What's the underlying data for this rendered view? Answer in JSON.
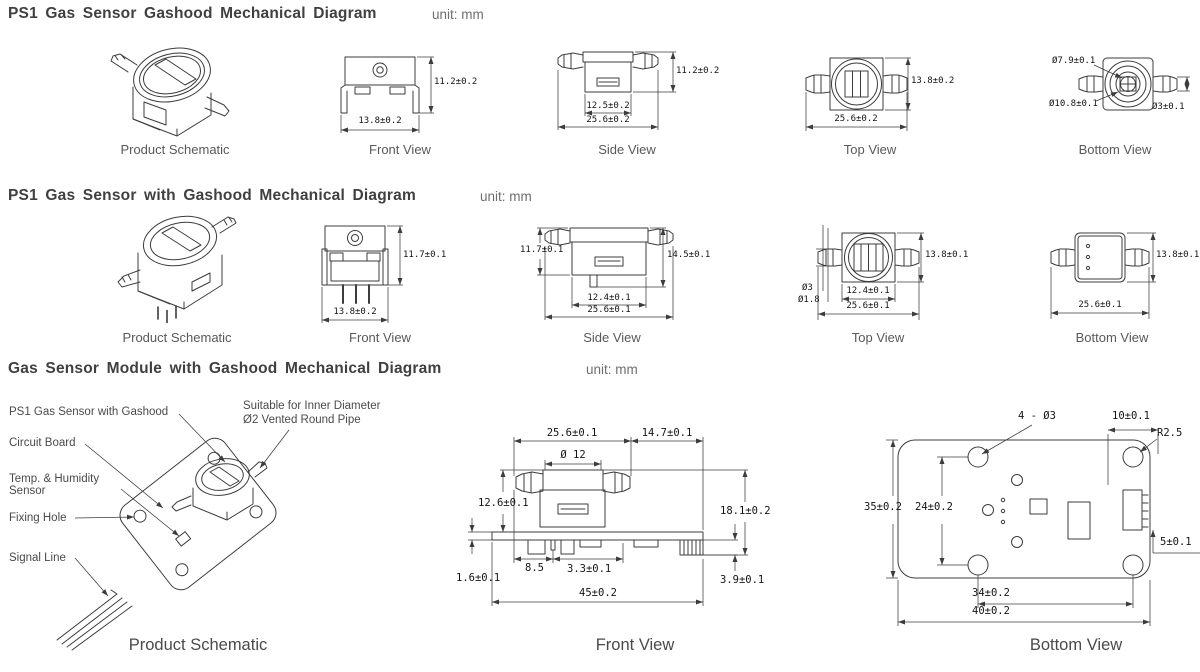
{
  "sections": [
    {
      "title": "PS1 Gas Sensor Gashood Mechanical Diagram",
      "unit": "unit: mm",
      "schematic": {
        "caption": "Product Schematic"
      },
      "front": {
        "caption": "Front View",
        "height": "11.2±0.2",
        "width": "13.8±0.2"
      },
      "side": {
        "caption": "Side View",
        "height": "11.2±0.2",
        "inner_width": "12.5±0.2",
        "width": "25.6±0.2"
      },
      "top": {
        "caption": "Top View",
        "height": "13.8±0.2",
        "width": "25.6±0.2"
      },
      "bottom": {
        "caption": "Bottom View",
        "inner_dia": "Ø7.9±0.1",
        "outer_dia": "Ø10.8±0.1",
        "nozzle_dia": "Ø3±0.1"
      }
    },
    {
      "title": "PS1 Gas Sensor with Gashood Mechanical Diagram",
      "unit": "unit: mm",
      "schematic": {
        "caption": "Product Schematic"
      },
      "front": {
        "caption": "Front View",
        "height": "11.7±0.1",
        "width": "13.8±0.2"
      },
      "side": {
        "caption": "Side View",
        "height": "11.7±0.1",
        "total_height": "14.5±0.1",
        "inner_width": "12.4±0.1",
        "width": "25.6±0.1"
      },
      "top": {
        "caption": "Top View",
        "height": "13.8±0.1",
        "inner_width": "12.4±0.1",
        "width": "25.6±0.1",
        "nozzle_od": "Ø3",
        "nozzle_id": "Ø1.8"
      },
      "bottom": {
        "caption": "Bottom View",
        "height": "13.8±0.1",
        "width": "25.6±0.1"
      }
    },
    {
      "title": "Gas Sensor Module with Gashood Mechanical Diagram",
      "unit": "unit: mm",
      "schematic": {
        "caption": "Product Schematic",
        "labels": {
          "sensor": "PS1 Gas Sensor with Gashood",
          "pipe_line1": "Suitable for Inner Diameter",
          "pipe_line2": "Ø2 Vented Round Pipe",
          "circuit_board": "Circuit Board",
          "temp_line1": "Temp. & Humidity",
          "temp_line2": "Sensor",
          "fixing_hole": "Fixing Hole",
          "signal_line": "Signal Line"
        }
      },
      "front": {
        "caption": "Front View",
        "sensor_width": "25.6±0.1",
        "right_span": "14.7±0.1",
        "hood_dia": "Ø 12",
        "sensor_height": "12.6±0.1",
        "total_height": "18.1±0.2",
        "pin_offset": "8.5",
        "pin_pitch": "3.3±0.1",
        "board_thickness": "1.6±0.1",
        "connector_drop": "3.9±0.1",
        "total_width": "45±0.2"
      },
      "bottom": {
        "caption": "Bottom View",
        "holes": "4 - Ø3",
        "right_span": "10±0.1",
        "corner_radius": "R2.5",
        "height": "35±0.2",
        "hole_pitch_v": "24±0.2",
        "connector_offset": "5±0.1",
        "hole_pitch_h": "34±0.2",
        "width": "40±0.2"
      }
    }
  ]
}
